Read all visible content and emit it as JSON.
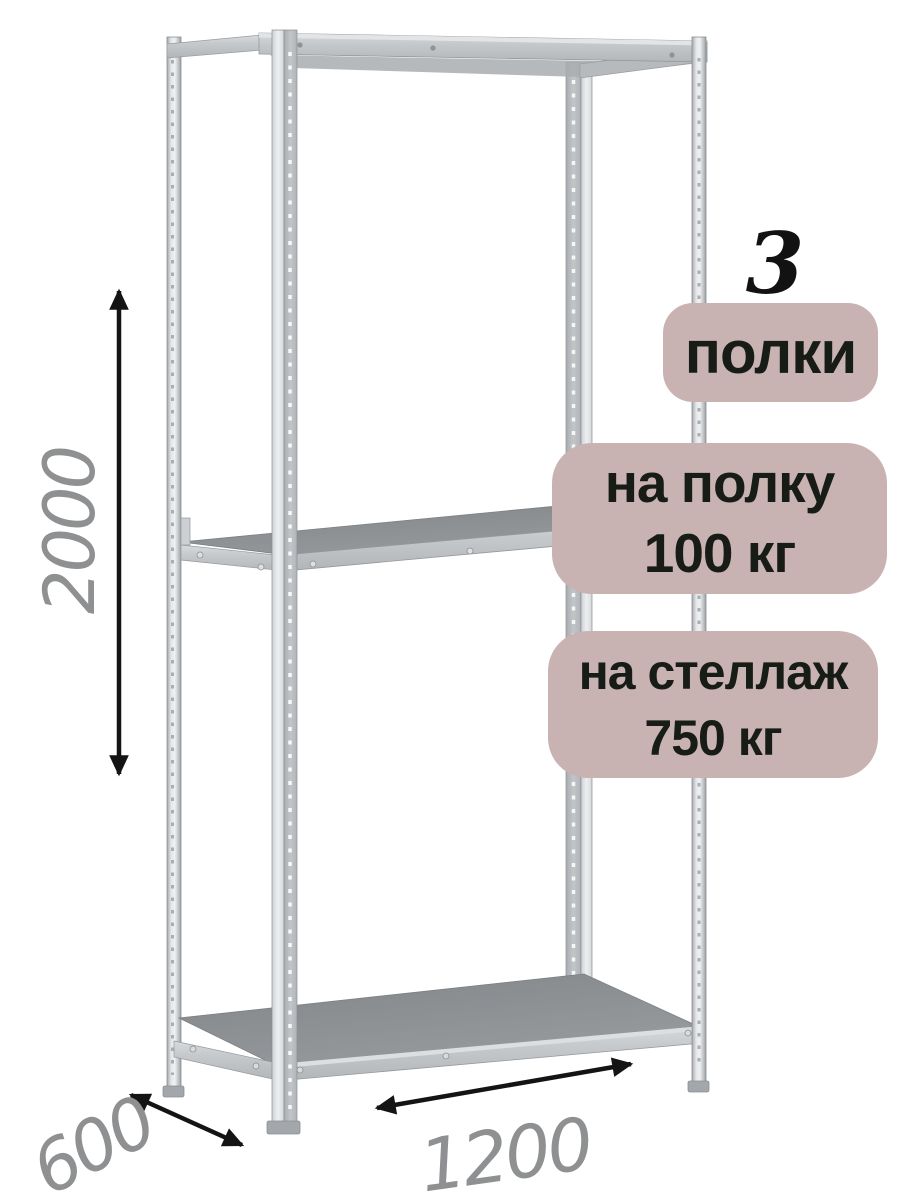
{
  "badges": {
    "count_number": "3",
    "count_label": "полки",
    "per_shelf_line1": "на полку",
    "per_shelf_line2": "100 кг",
    "per_rack_line1": "на стеллаж",
    "per_rack_line2": "750 кг"
  },
  "dimensions": {
    "height_mm": "2000",
    "depth_mm": "600",
    "width_mm": "1200"
  },
  "colors": {
    "badge_bg": "#c9b3b2",
    "badge_text": "#171c17",
    "count_text": "#121212",
    "dimension_text": "#8e9092",
    "arrow": "#141414",
    "metal_light": "#e7e9eb",
    "metal_mid": "#c4c8cb",
    "metal_shadow": "#9ba0a4",
    "shelf_top": "#8b8f92",
    "background": "#ffffff"
  }
}
